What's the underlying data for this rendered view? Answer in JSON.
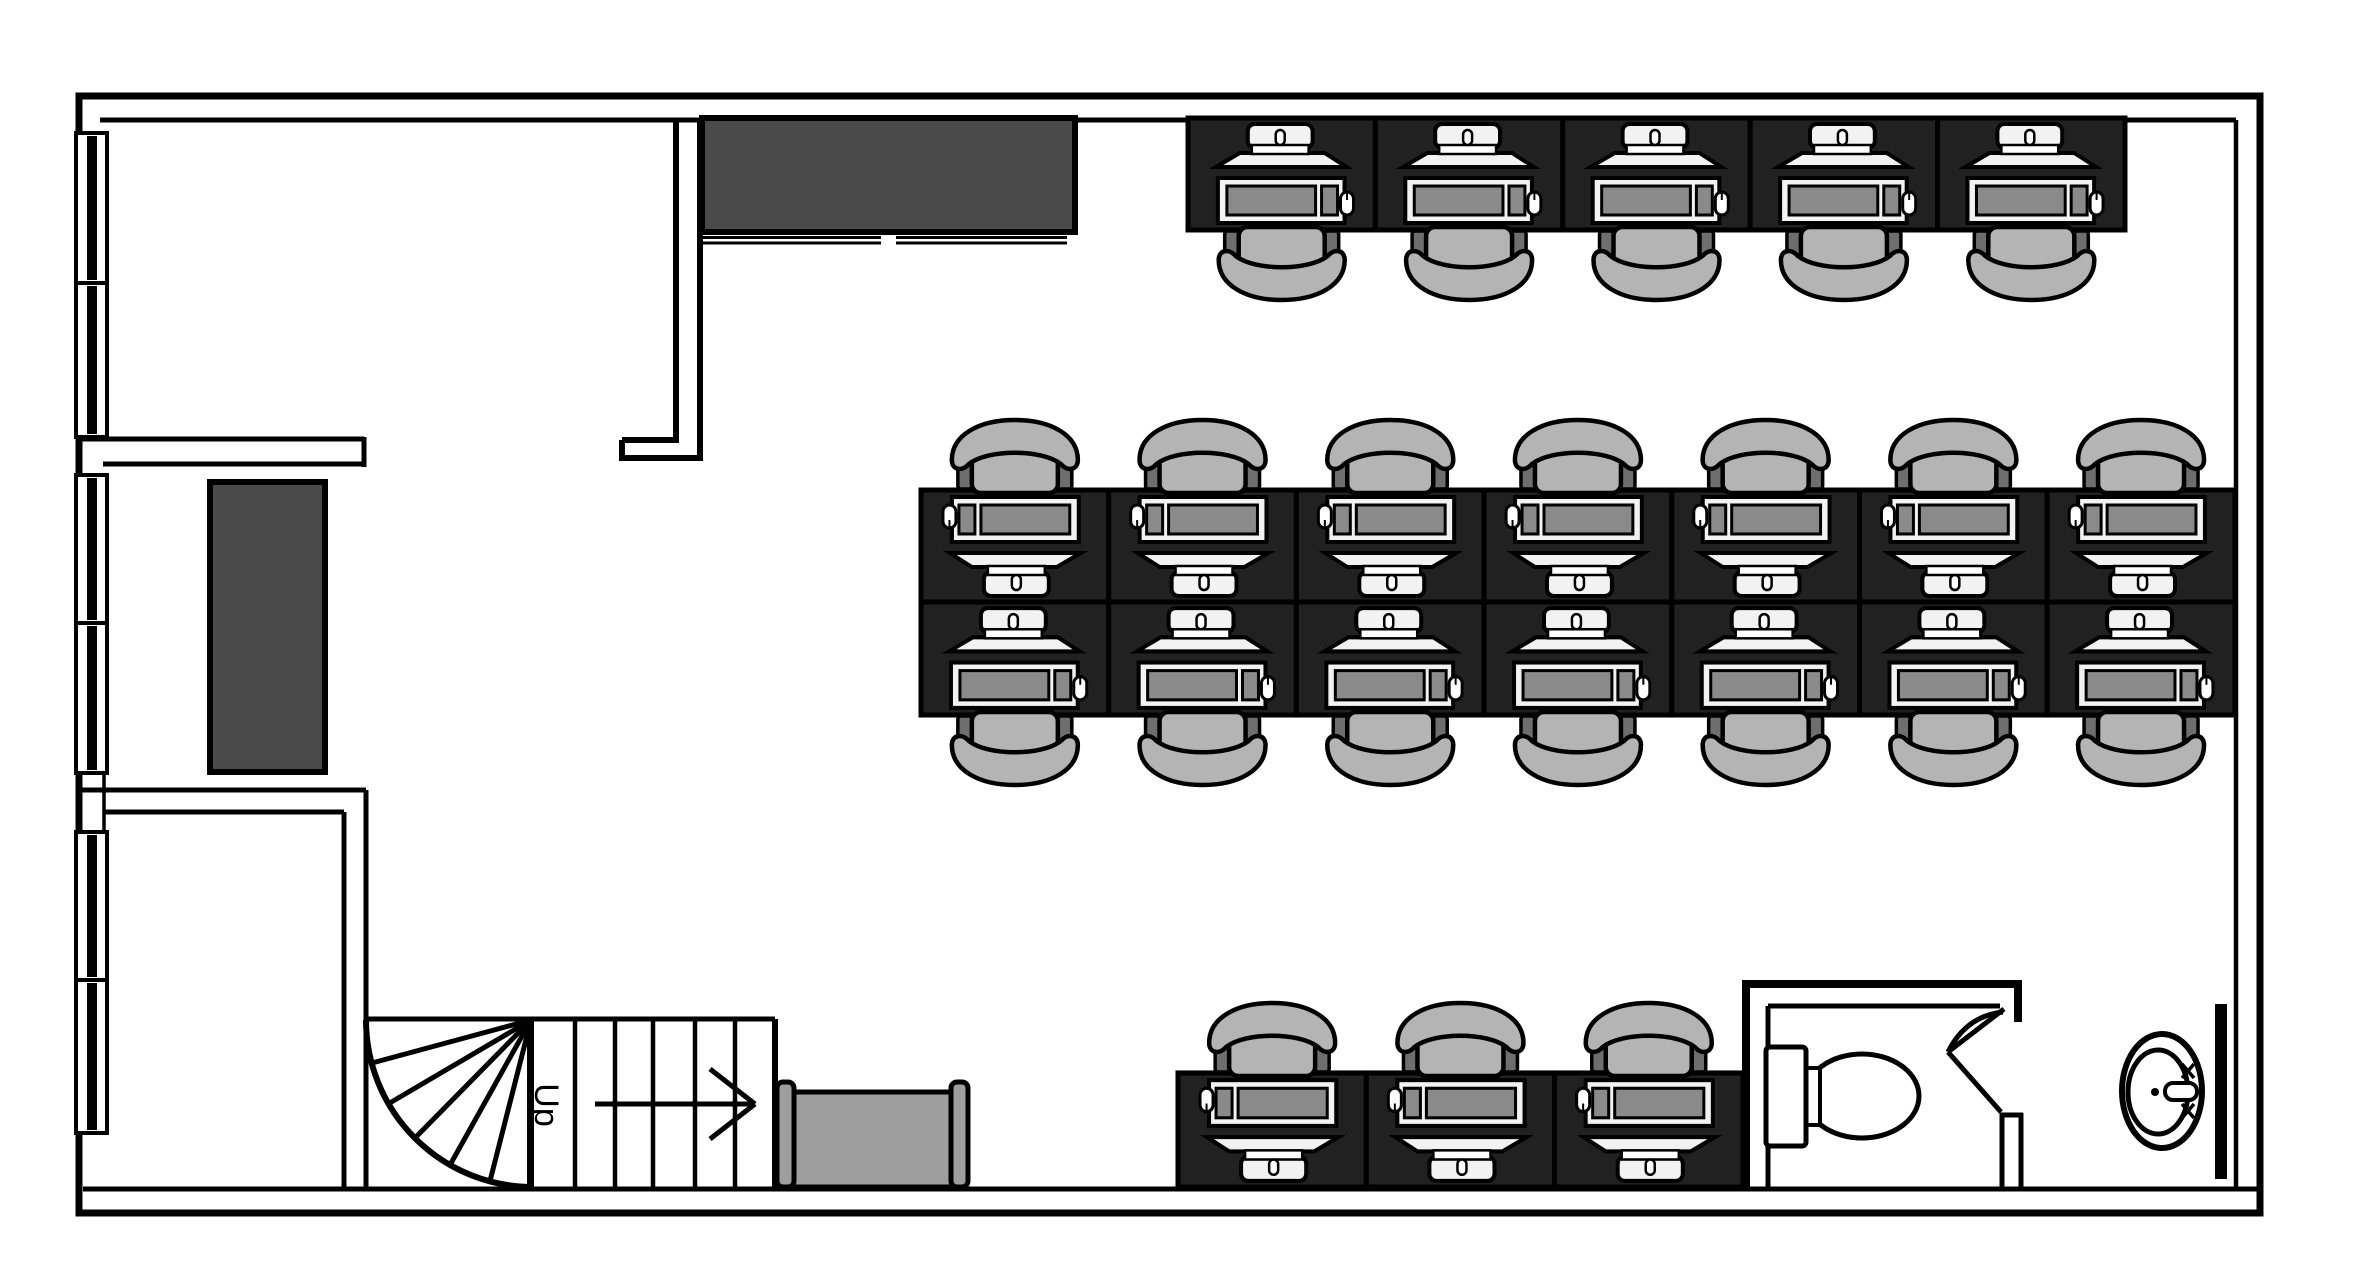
{
  "meta": {
    "type": "floor-plan",
    "description": "Single-storey office floor plan with desk workstations, meeting room, storage room, staircase, washroom and sink"
  },
  "labels": {
    "stairs_direction": "Up"
  },
  "palette": {
    "wall": "#000000",
    "floor": "#ffffff",
    "board": "#4a4a4a",
    "cabinet": "#4a4a4a",
    "desk": "#212121",
    "chair_seat": "#b4b4b4",
    "chair_arm": "#6e6e6e",
    "screen": "#8a8a8a",
    "device": "#f2f2f2",
    "device_bright": "#ffffff",
    "bench": "#9e9e9e",
    "fixture": "#ffffff"
  },
  "furniture": {
    "desk_equipment": [
      "laptop-icon",
      "monitor-icon",
      "mouse-icon"
    ],
    "desk_rows": [
      {
        "id": "top",
        "facing": "down",
        "x": 1188,
        "y": 118,
        "desk_w": 187.4,
        "desk_h": 112,
        "count": 5
      },
      {
        "id": "middle-north",
        "facing": "up",
        "x": 921,
        "y": 490,
        "desk_w": 187.7,
        "desk_h": 112,
        "count": 7
      },
      {
        "id": "middle-south",
        "facing": "down",
        "x": 921,
        "y": 602,
        "desk_w": 187.7,
        "desk_h": 113,
        "count": 7
      },
      {
        "id": "bottom",
        "facing": "up",
        "x": 1178,
        "y": 1073,
        "desk_w": 188.3,
        "desk_h": 114,
        "count": 3
      }
    ]
  },
  "windows_left": [
    {
      "y1": 133,
      "y2": 283
    },
    {
      "y1": 283,
      "y2": 437
    },
    {
      "y1": 475,
      "y2": 623
    },
    {
      "y1": 623,
      "y2": 773
    },
    {
      "y1": 832,
      "y2": 980
    },
    {
      "y1": 980,
      "y2": 1133
    }
  ]
}
